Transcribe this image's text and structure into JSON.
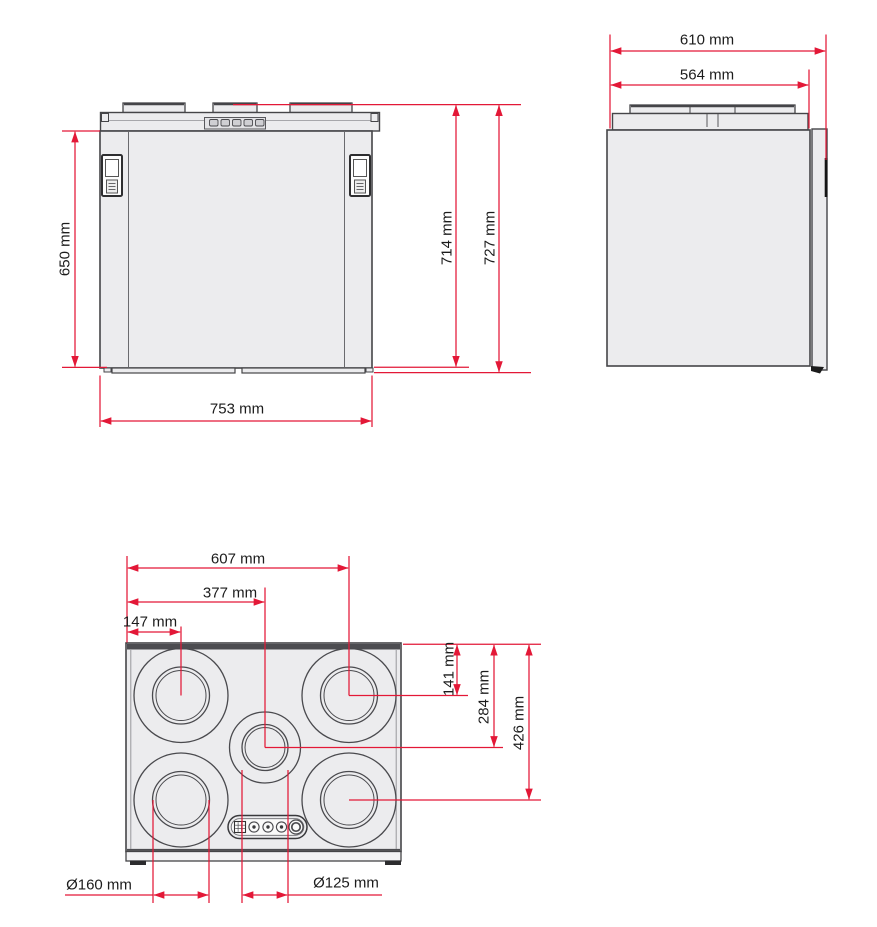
{
  "drawing_title": "Unit dimensional drawing (front, side and top views)",
  "colors": {
    "dimension_red": "#e31837",
    "line_gray": "#454548",
    "fill_gray": "#ececee"
  },
  "front_view": {
    "height_body": "650 mm",
    "height_unit": "714 mm",
    "height_total": "727 mm",
    "width": "753 mm"
  },
  "side_view": {
    "depth_total": "610 mm",
    "depth_body": "564 mm"
  },
  "top_view": {
    "port_col_left": "147 mm",
    "port_col_center": "377 mm",
    "port_col_right": "607 mm",
    "port_row_top": "141 mm",
    "port_row_center": "284 mm",
    "port_row_bottom": "426 mm",
    "diameter_large_ports": "Ø160 mm",
    "diameter_center_port": "Ø125 mm"
  }
}
